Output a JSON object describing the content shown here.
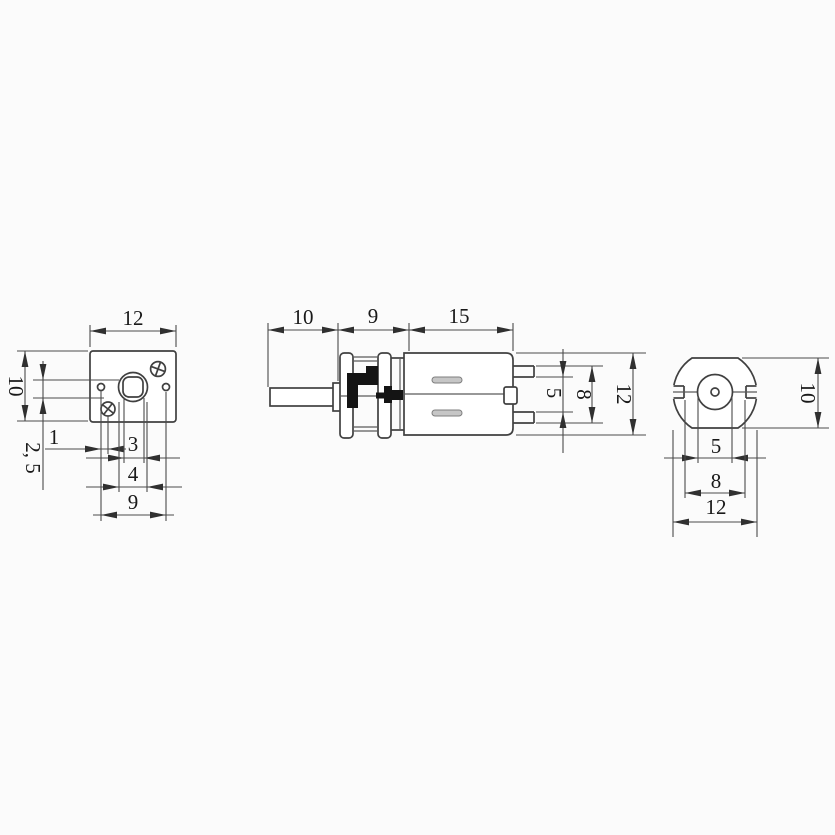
{
  "title": "micro gear motor dimension drawing",
  "colors": {
    "background": "#fbfbfb",
    "part_line": "#404040",
    "dimension_line": "#4b4b4b",
    "text": "#191919",
    "gear_silhouette": "#141414",
    "vent_slot": "#c6c6c6"
  },
  "front_view": {
    "width": "12",
    "height": "10",
    "vertical_offset": "2, 5",
    "hole_pitch": "1",
    "shaft_hole_width": "3",
    "boss_width": "4",
    "hole_span": "9"
  },
  "side_view": {
    "shaft_length": "10",
    "gearbox_length": "9",
    "motor_length": "15",
    "terminal_inner": "5",
    "terminal_outer": "8",
    "body_height": "12"
  },
  "rear_view": {
    "flat_height": "10",
    "boss_diameter": "5",
    "flat_width": "8",
    "body_diameter": "12"
  }
}
